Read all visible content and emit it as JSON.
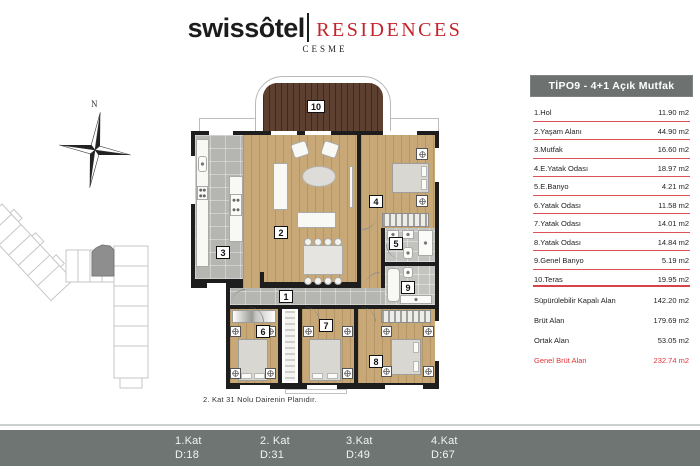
{
  "logo": {
    "brand": "swissôtel",
    "brand2": "RESIDENCES",
    "city": "CESME"
  },
  "compass": {
    "north_label": "N"
  },
  "panel": {
    "title": "TİPO9 - 4+1 Açık Mutfak",
    "rooms": [
      {
        "label": "1.Hol",
        "area": "11.90 m2"
      },
      {
        "label": "2.Yaşam Alanı",
        "area": "44.90 m2"
      },
      {
        "label": "3.Mutfak",
        "area": "16.60 m2"
      },
      {
        "label": "4.E.Yatak Odası",
        "area": "18.97 m2"
      },
      {
        "label": "5.E.Banyo",
        "area": "4.21 m2"
      },
      {
        "label": "6.Yatak Odası",
        "area": "11.58 m2"
      },
      {
        "label": "7.Yatak Odası",
        "area": "14.01 m2"
      },
      {
        "label": "8.Yatak Odası",
        "area": "14.84 m2"
      },
      {
        "label": "9.Genel Banyo",
        "area": "5.19 m2"
      },
      {
        "label": "10.Teras",
        "area": "19.95 m2"
      }
    ],
    "summary": [
      {
        "label": "Süpürülebilir Kapalı Alan",
        "area": "142.20 m2"
      },
      {
        "label": "Brüt Alan",
        "area": "179.69 m2"
      },
      {
        "label": "Ortak Alan",
        "area": "53.05 m2"
      }
    ],
    "total": {
      "label": "Genel Brüt Alan",
      "area": "232.74 m2"
    }
  },
  "plan": {
    "room_labels": [
      "10",
      "2",
      "3",
      "4",
      "5",
      "9",
      "1",
      "6",
      "7",
      "8"
    ],
    "caption": "2. Kat 31 Nolu Dairenin Planıdır."
  },
  "footer": {
    "floors": [
      {
        "kat": "1.Kat",
        "daire": "D:18"
      },
      {
        "kat": "2. Kat",
        "daire": "D:31"
      },
      {
        "kat": "3.Kat",
        "daire": "D:49"
      },
      {
        "kat": "4.Kat",
        "daire": "D:67"
      }
    ]
  },
  "colors": {
    "accent_red": "#c4242c",
    "table_line_red": "#dd5157",
    "total_red": "#e2343a",
    "header_gray": "#6d7270",
    "footer_gray": "#6f7573",
    "wood_light": "#c9a878",
    "wood_dark": "#5e4030",
    "tile_gray": "#b5b5b2",
    "wall": "#1d1d1d"
  }
}
